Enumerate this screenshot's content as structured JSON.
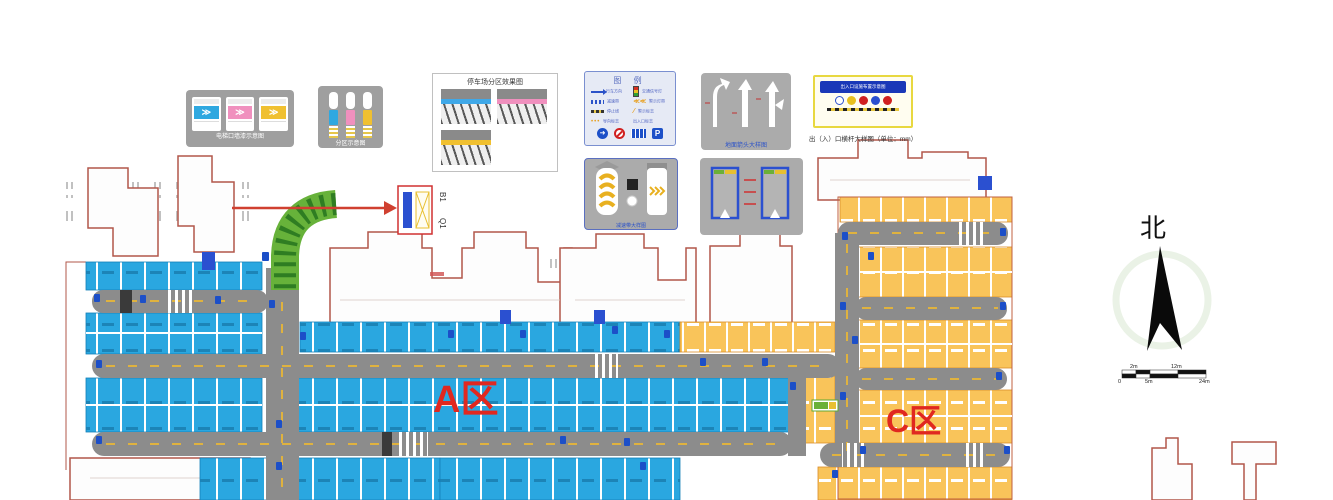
{
  "plan": {
    "zone_a": "A区",
    "zone_c": "C区",
    "callout_top": "B1",
    "callout_bottom": "Q1"
  },
  "compass": {
    "north": "北"
  },
  "scale_bar": {
    "labels": [
      "0",
      "2m",
      "5m",
      "12m",
      "24m"
    ]
  },
  "colors": {
    "stall_blue": "#2aa7e0",
    "stall_orange": "#f9c45a",
    "road_gray": "#8c8c8c",
    "ramp_green": "#67b23a",
    "zone_label_red": "#e02820",
    "building_outline": "#b2574a"
  },
  "boxes": {
    "elevator": {
      "caption": "电梯口墙漆示意图",
      "arrow_glyph": "≫"
    },
    "zoning": {
      "caption": "分区示意图"
    },
    "effect": {
      "title": "停车场分区效果图"
    },
    "legend": {
      "title": "图 例",
      "left": [
        "行车方向",
        "减速带",
        "停止线",
        "导向标志"
      ],
      "right": [
        "交通信号灯",
        "警示灯带",
        "警示标志",
        "出入口标志"
      ],
      "parking_glyph": "P"
    },
    "arrows": {
      "caption": "地面箭头大样图"
    },
    "barrier": {
      "banner": "出入口设施布置示意图",
      "caption": "出（入）口横杆大样图（单位：mm）"
    },
    "speedbump": {
      "caption": "减速带大样图"
    },
    "space": {
      "caption": "停车位大样图"
    }
  }
}
